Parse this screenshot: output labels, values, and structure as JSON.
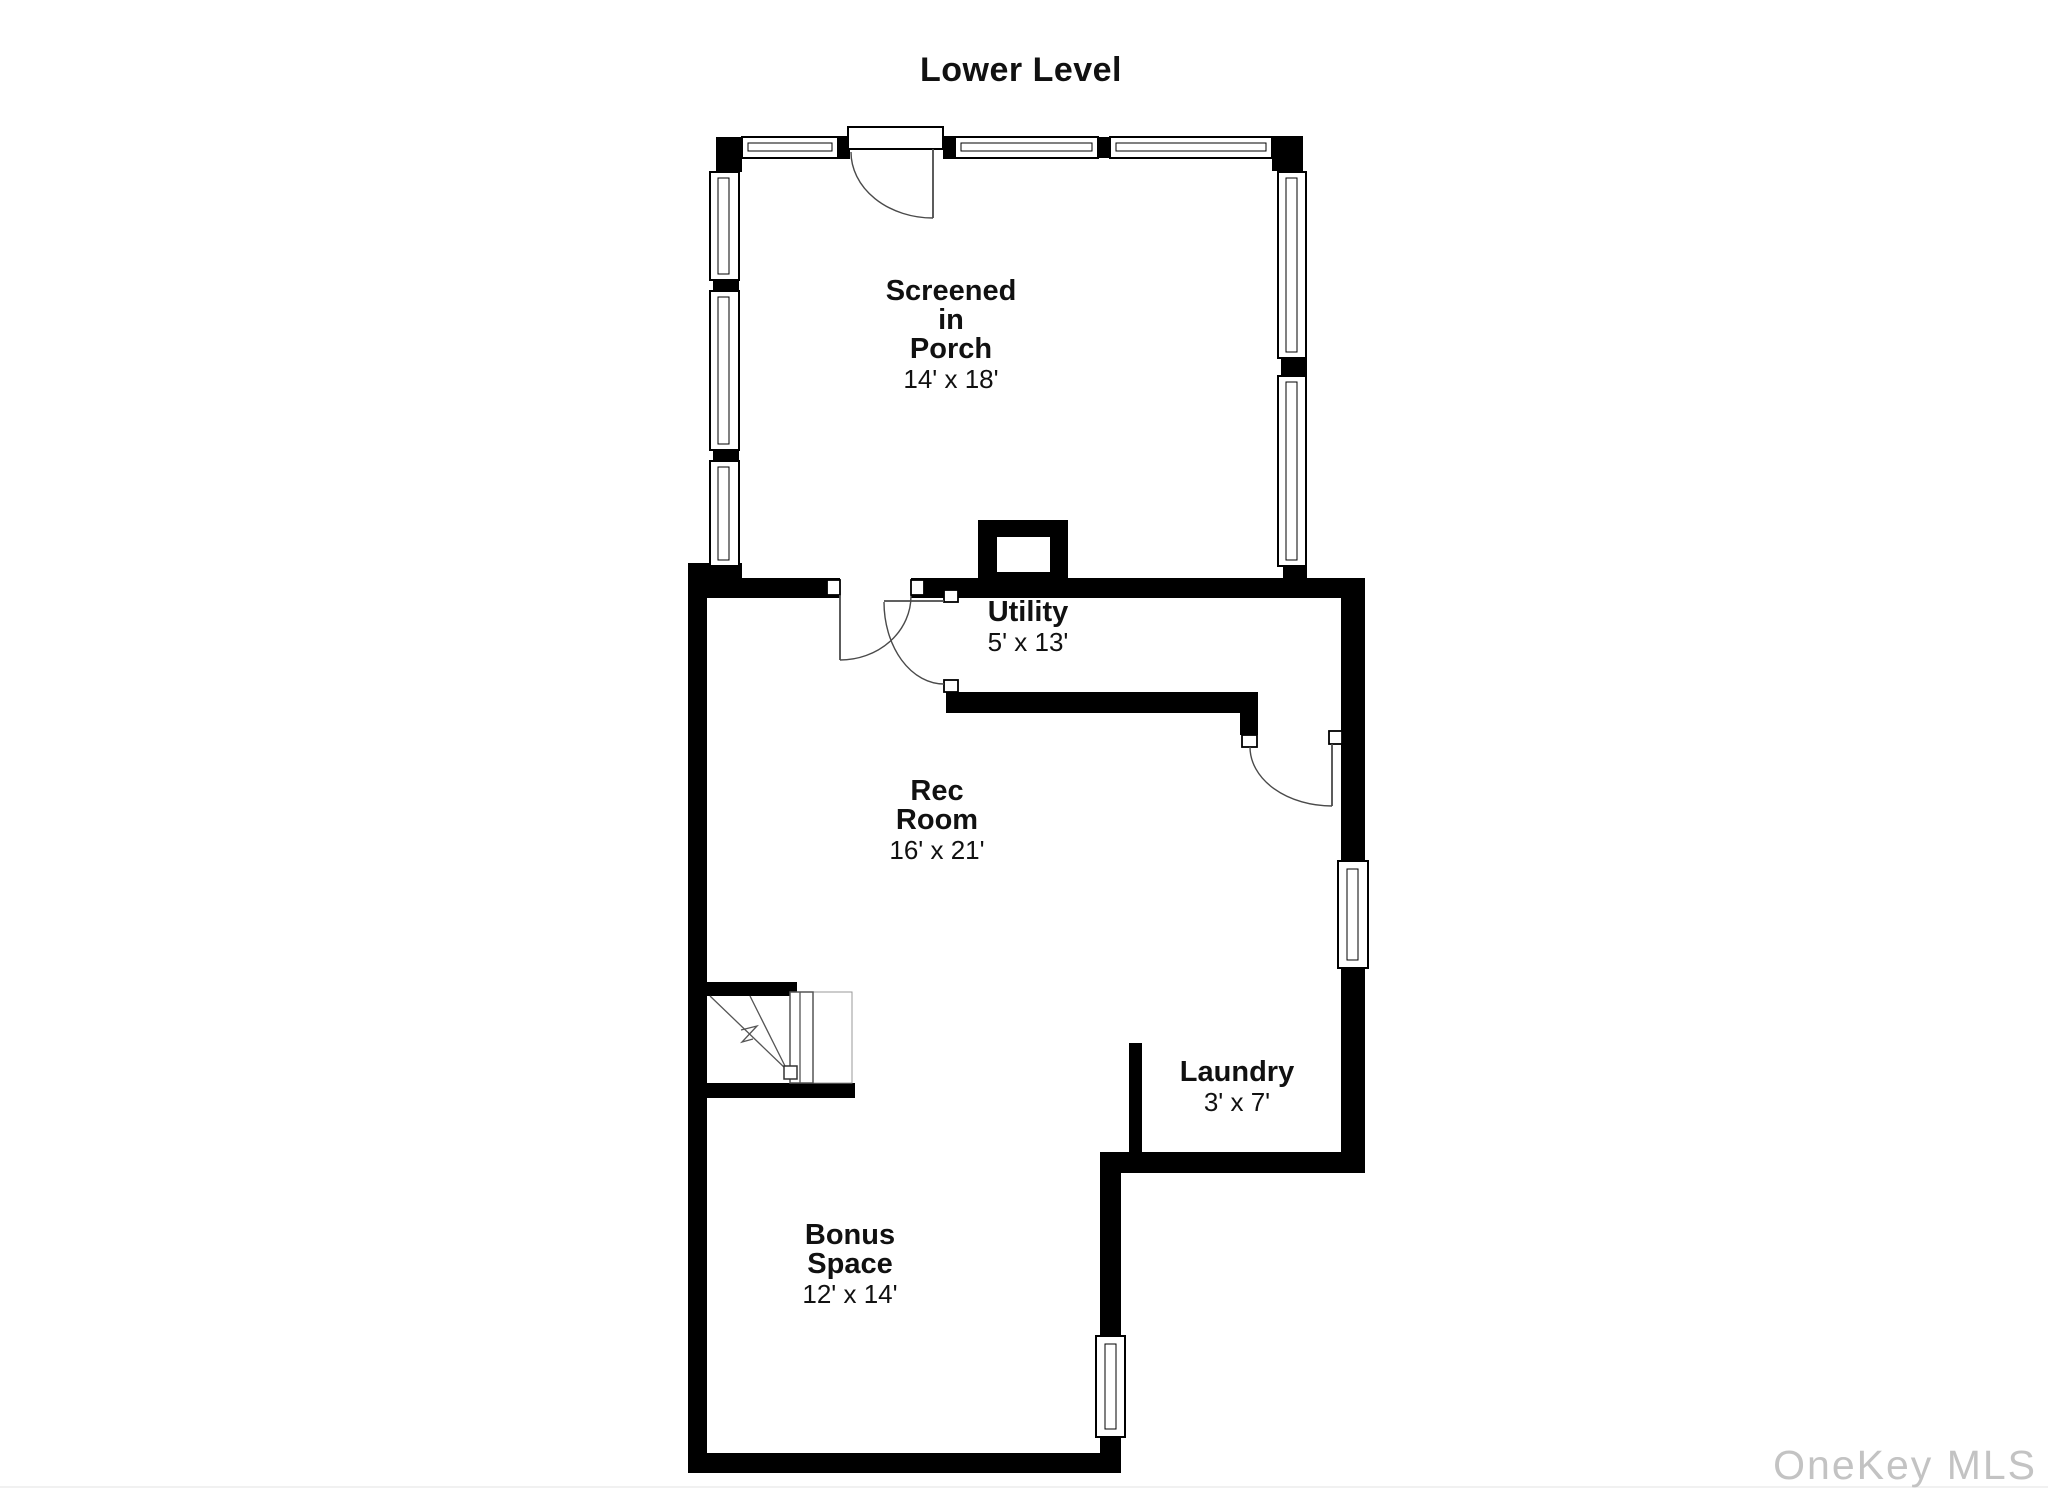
{
  "page": {
    "title": "Lower Level",
    "watermark": "OneKey MLS"
  },
  "colors": {
    "wall": "#000000",
    "background": "#ffffff",
    "ink": "#111111",
    "watermark_text": "#c3c3c3"
  },
  "rooms": {
    "porch": {
      "label": [
        "Screened",
        "in",
        "Porch"
      ],
      "dims": "14' x 18'"
    },
    "utility": {
      "label": [
        "Utility"
      ],
      "dims": "5' x 13'"
    },
    "rec": {
      "label": [
        "Rec",
        "Room"
      ],
      "dims": "16' x 21'"
    },
    "laundry": {
      "label": [
        "Laundry"
      ],
      "dims": "3' x 7'"
    },
    "bonus": {
      "label": [
        "Bonus",
        "Space"
      ],
      "dims": "12' x 14'"
    }
  }
}
